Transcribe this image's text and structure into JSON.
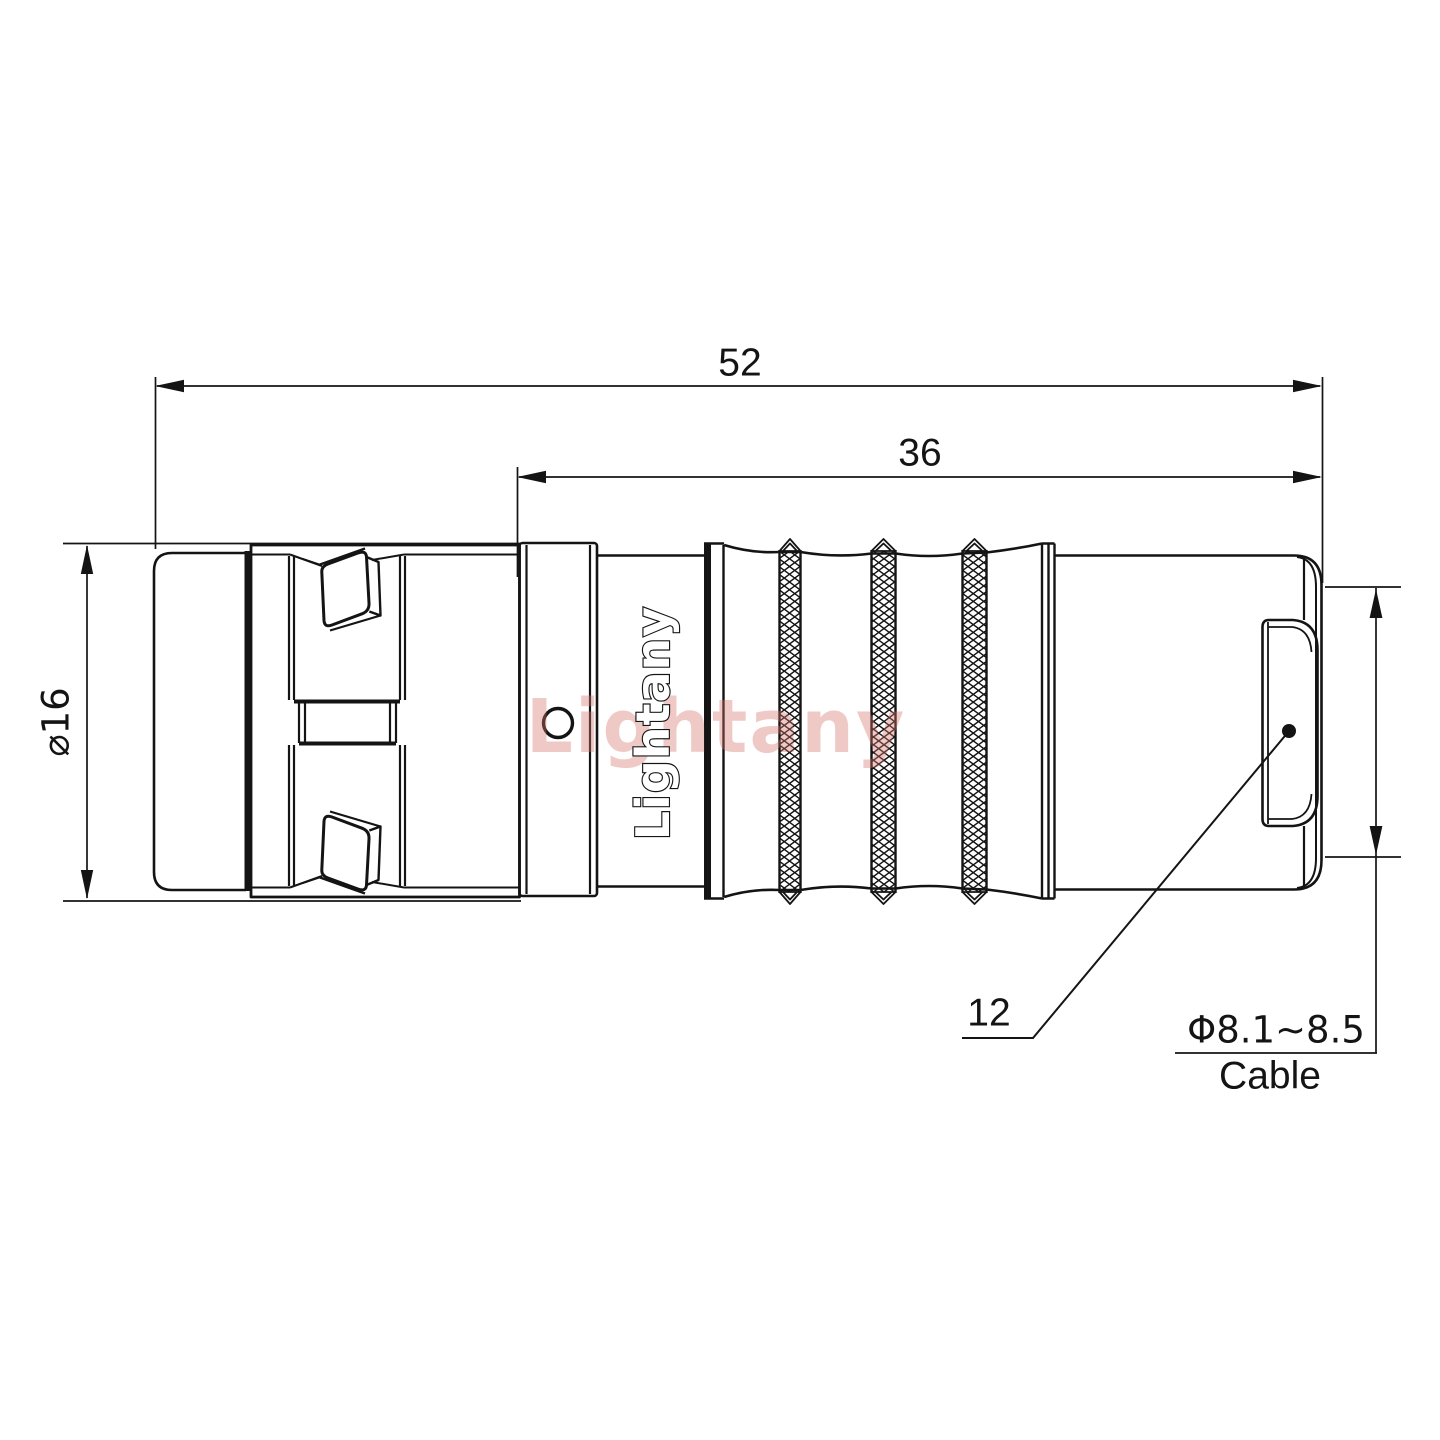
{
  "colors": {
    "line": "#141414",
    "background": "#ffffff",
    "watermark": "#d6736c"
  },
  "dimensions": {
    "total_length": "52",
    "rear_length": "36",
    "body_diameter": "⌀16",
    "rear_nut_size": "12",
    "cable_range": "Φ8.1~8.5",
    "cable_label": "Cable"
  },
  "branding": {
    "logo_text": "Lightany",
    "watermark_text": "Lightany"
  }
}
